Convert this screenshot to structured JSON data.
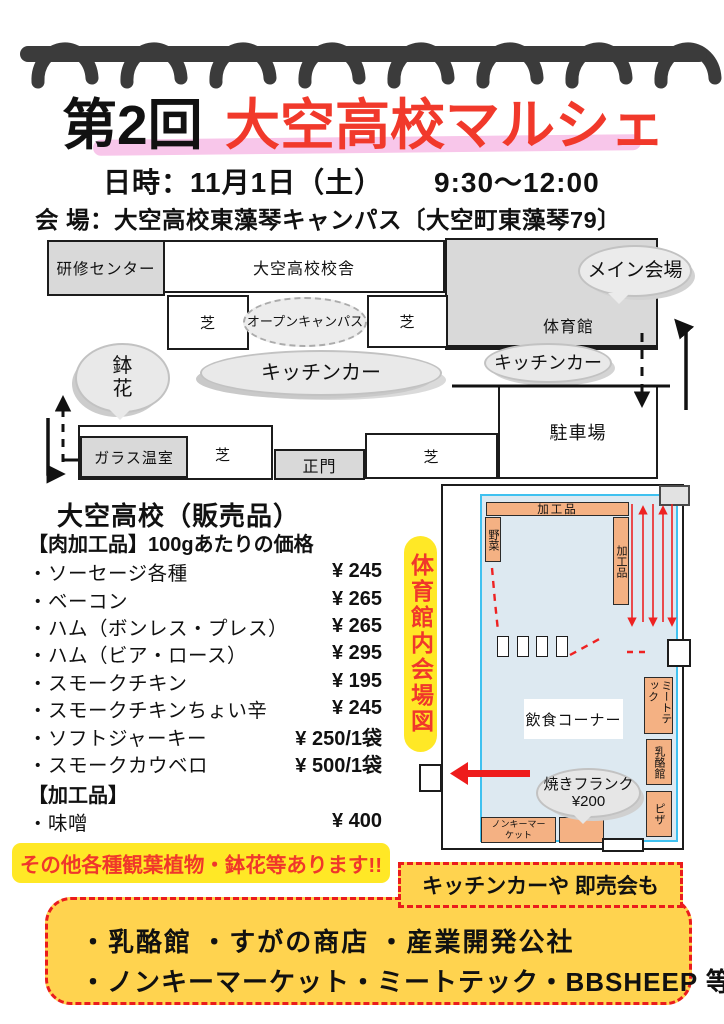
{
  "header": {
    "edition": "第2回",
    "title": "大空高校マルシェ",
    "date_label": "日時：11月1日（土）",
    "time": "9:30～12:00",
    "venue": "会 場：大空高校東藻琴キャンパス〔大空町東藻琴79〕"
  },
  "campus_map": {
    "training_center": "研修センター",
    "school_building": "大空高校校舎",
    "gym": "体育館",
    "main_venue_bubble": "メイン会場",
    "open_campus_bubble": "オープンキャンパス",
    "kitchen_car_bubbles": [
      "キッチンカー",
      "キッチンカー"
    ],
    "potted_flower_bubble": "鉢花",
    "lawns": [
      "芝",
      "芝",
      "芝"
    ],
    "greenhouse": "ガラス温室",
    "main_gate": "正門",
    "parking": "駐車場"
  },
  "price_list": {
    "title": "大空高校（販売品）",
    "meat_section": "【肉加工品】100gあたりの価格",
    "items": [
      {
        "name": "・ソーセージ各種",
        "price": "¥ 245"
      },
      {
        "name": "・ベーコン",
        "price": "¥ 265"
      },
      {
        "name": "・ハム（ボンレス・プレス）",
        "price": "¥ 265"
      },
      {
        "name": "・ハム（ビア・ロース）",
        "price": "¥ 295"
      },
      {
        "name": "・スモークチキン",
        "price": "¥ 195"
      },
      {
        "name": "・スモークチキンちょい辛",
        "price": "¥ 245"
      },
      {
        "name": "・ソフトジャーキー",
        "price": "¥ 250/1袋"
      },
      {
        "name": "・スモークカウベロ",
        "price": "¥ 500/1袋"
      }
    ],
    "processed_section": "【加工品】",
    "processed_items": [
      {
        "name": "・味噌",
        "price": "¥ 400"
      }
    ]
  },
  "gym_map": {
    "side_label": "体育館内会場図",
    "top_booth": "加工品",
    "left_booth": "野菜",
    "right_booth": "加工品",
    "food_corner": "飲食コーナー",
    "meat_tech_booth": "ミートテック",
    "dairy_booth": "乳酪館",
    "pizza_booth": "ピザ",
    "nonkey_booth": "ノンキーマーケット",
    "frank_bubble_line1": "焼きフランク",
    "frank_bubble_line2": "¥200"
  },
  "footer": {
    "plants_note": "その他各種観葉植物・鉢花等あります!!",
    "kitchen_note": "キッチンカーや 即売会も",
    "vendors_line1": "・乳酪館 ・すがの商店 ・産業開発公社",
    "vendors_line2": "・ノンキーマーケット・ミートテック・BBSHEEP 等"
  },
  "colors": {
    "title_red": "#f1392b",
    "highlight_pink": "#f8c6ea",
    "highlight_yellow": "#ffe826",
    "footer_yellow": "#ffd34f",
    "dashed_red": "#ea1c1c",
    "booth_orange": "#f4b183",
    "gym_floor_blue": "#dde9f1",
    "gym_floor_border": "#3fc1f0",
    "map_gray": "#d9d9d9",
    "coil_gray": "#3b3b3b"
  }
}
